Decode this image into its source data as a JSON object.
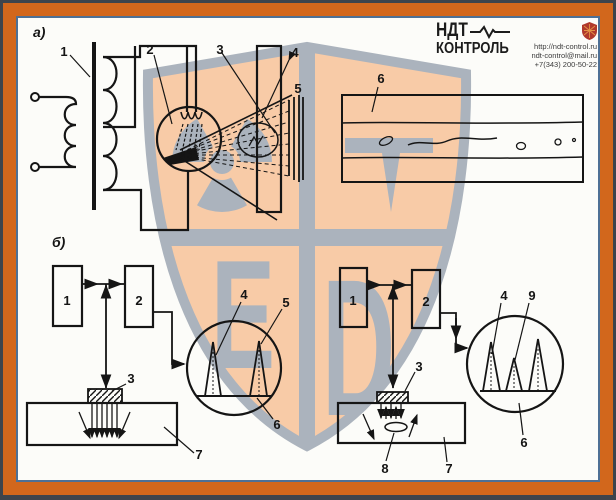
{
  "header": {
    "brand_line1": "НДТ",
    "brand_line2": "КОНТРОЛЬ",
    "contact": {
      "website": "http://ndt-control.ru",
      "email": "ndt-control@mail.ru",
      "phone": "+7(343) 200-50-22"
    }
  },
  "figure": {
    "section_a": {
      "label": "а)",
      "callouts": {
        "transformer": "1",
        "xray_tube": "2",
        "xray_beam": "3",
        "specimen": "4",
        "film": "5",
        "radiograph": "6"
      }
    },
    "section_b_left": {
      "label": "б)",
      "callouts": {
        "generator": "1",
        "receiver": "2",
        "transducer": "3",
        "initial_pulse": "4",
        "bottom_echo": "5",
        "screen": "6",
        "specimen": "7"
      }
    },
    "section_b_right": {
      "callouts": {
        "generator": "1",
        "receiver": "2",
        "transducer": "3",
        "initial_pulse": "4",
        "defect_echo": "9",
        "screen": "6",
        "specimen": "7",
        "defect": "8"
      }
    }
  },
  "watermark": {
    "letter_bl": "Е",
    "letter_br": "D"
  },
  "colors": {
    "frame_orange": "#d2671c",
    "frame_blue": "#4e7095",
    "watermark_fill": "#f8cba7",
    "watermark_gray": "#abb3bd",
    "logo_shield_red": "#b0392c",
    "line_black": "#151515"
  }
}
